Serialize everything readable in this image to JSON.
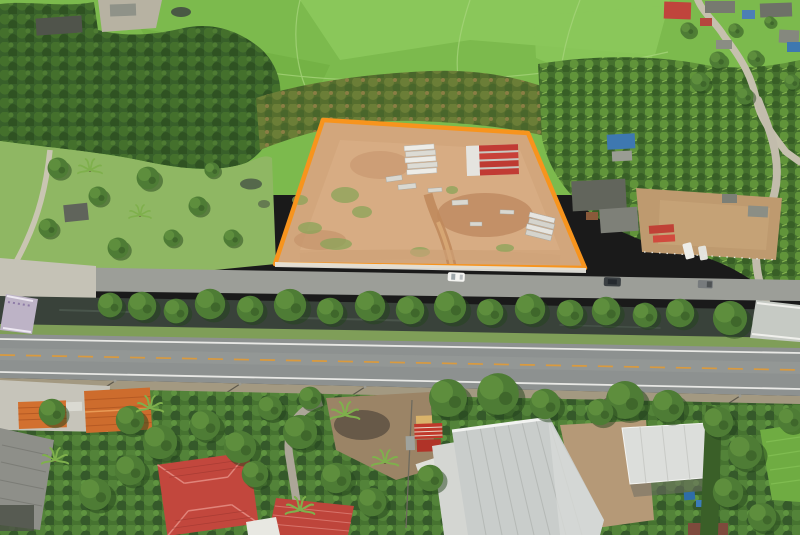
{
  "scene": {
    "kind": "aerial drone photograph",
    "subject": "roadside land plot outlined in orange",
    "land_plot": {
      "outline_color": "#F7941D",
      "surface": "cleared reddish-tan dirt",
      "items_inside": [
        "stacked white precast slabs",
        "red-capped material stacks",
        "scattered pallets",
        "dirt access track",
        "weed patches"
      ]
    },
    "surroundings": {
      "north": [
        "bright green rice paddies",
        "dark orchard tree band",
        "village with red, blue and gray roofs",
        "winding village road",
        "small pond",
        "barn clearing"
      ],
      "west": [
        "grass field with scattered trees",
        "two small ponds",
        "hut",
        "concrete lane"
      ],
      "east": [
        "banana and palm grove",
        "gray-roofed houses",
        "fenced dirt compound with red trailers and white pickups",
        "side road to canal bridge"
      ],
      "south": [
        "frontage road",
        "tree-lined irrigation canal",
        "two-lane asphalt highway with orange center line and white edge lines",
        "gravel shoulder with power poles",
        "houses with orange, gray and red roofs",
        "large white-roofed warehouse",
        "white open shed with blue items",
        "bright green field strip"
      ]
    },
    "bridges": [
      "canal bridge with purple-white railing at left",
      "canal bridge at right"
    ],
    "vehicles": [
      "white car on frontage road",
      "dark SUV on frontage road",
      "gray pickup on frontage road",
      "two white pickups in compound",
      "red trailers in compound"
    ]
  },
  "colors": {
    "plot_outline": "#F7941D",
    "plot_dirt": "#D2A67C",
    "paddy_green": "#7CBA4D",
    "grass_field": "#8FB763",
    "canal_water": "#39423A",
    "highway_asphalt": "#8D9190",
    "center_line": "#D99A3F",
    "edge_line": "#E8E8E5",
    "frontage_road": "#9C9E98",
    "gravel_shoulder": "#B3A78D",
    "warehouse_roof": "#C9CDCB",
    "shed_roof": "#DCDEDB",
    "red_roof": "#C2473D",
    "orange_roof": "#D2702F",
    "gray_roof": "#8E8F89",
    "blue_roof": "#4C7FB5",
    "village_road": "#C6C0AE"
  }
}
